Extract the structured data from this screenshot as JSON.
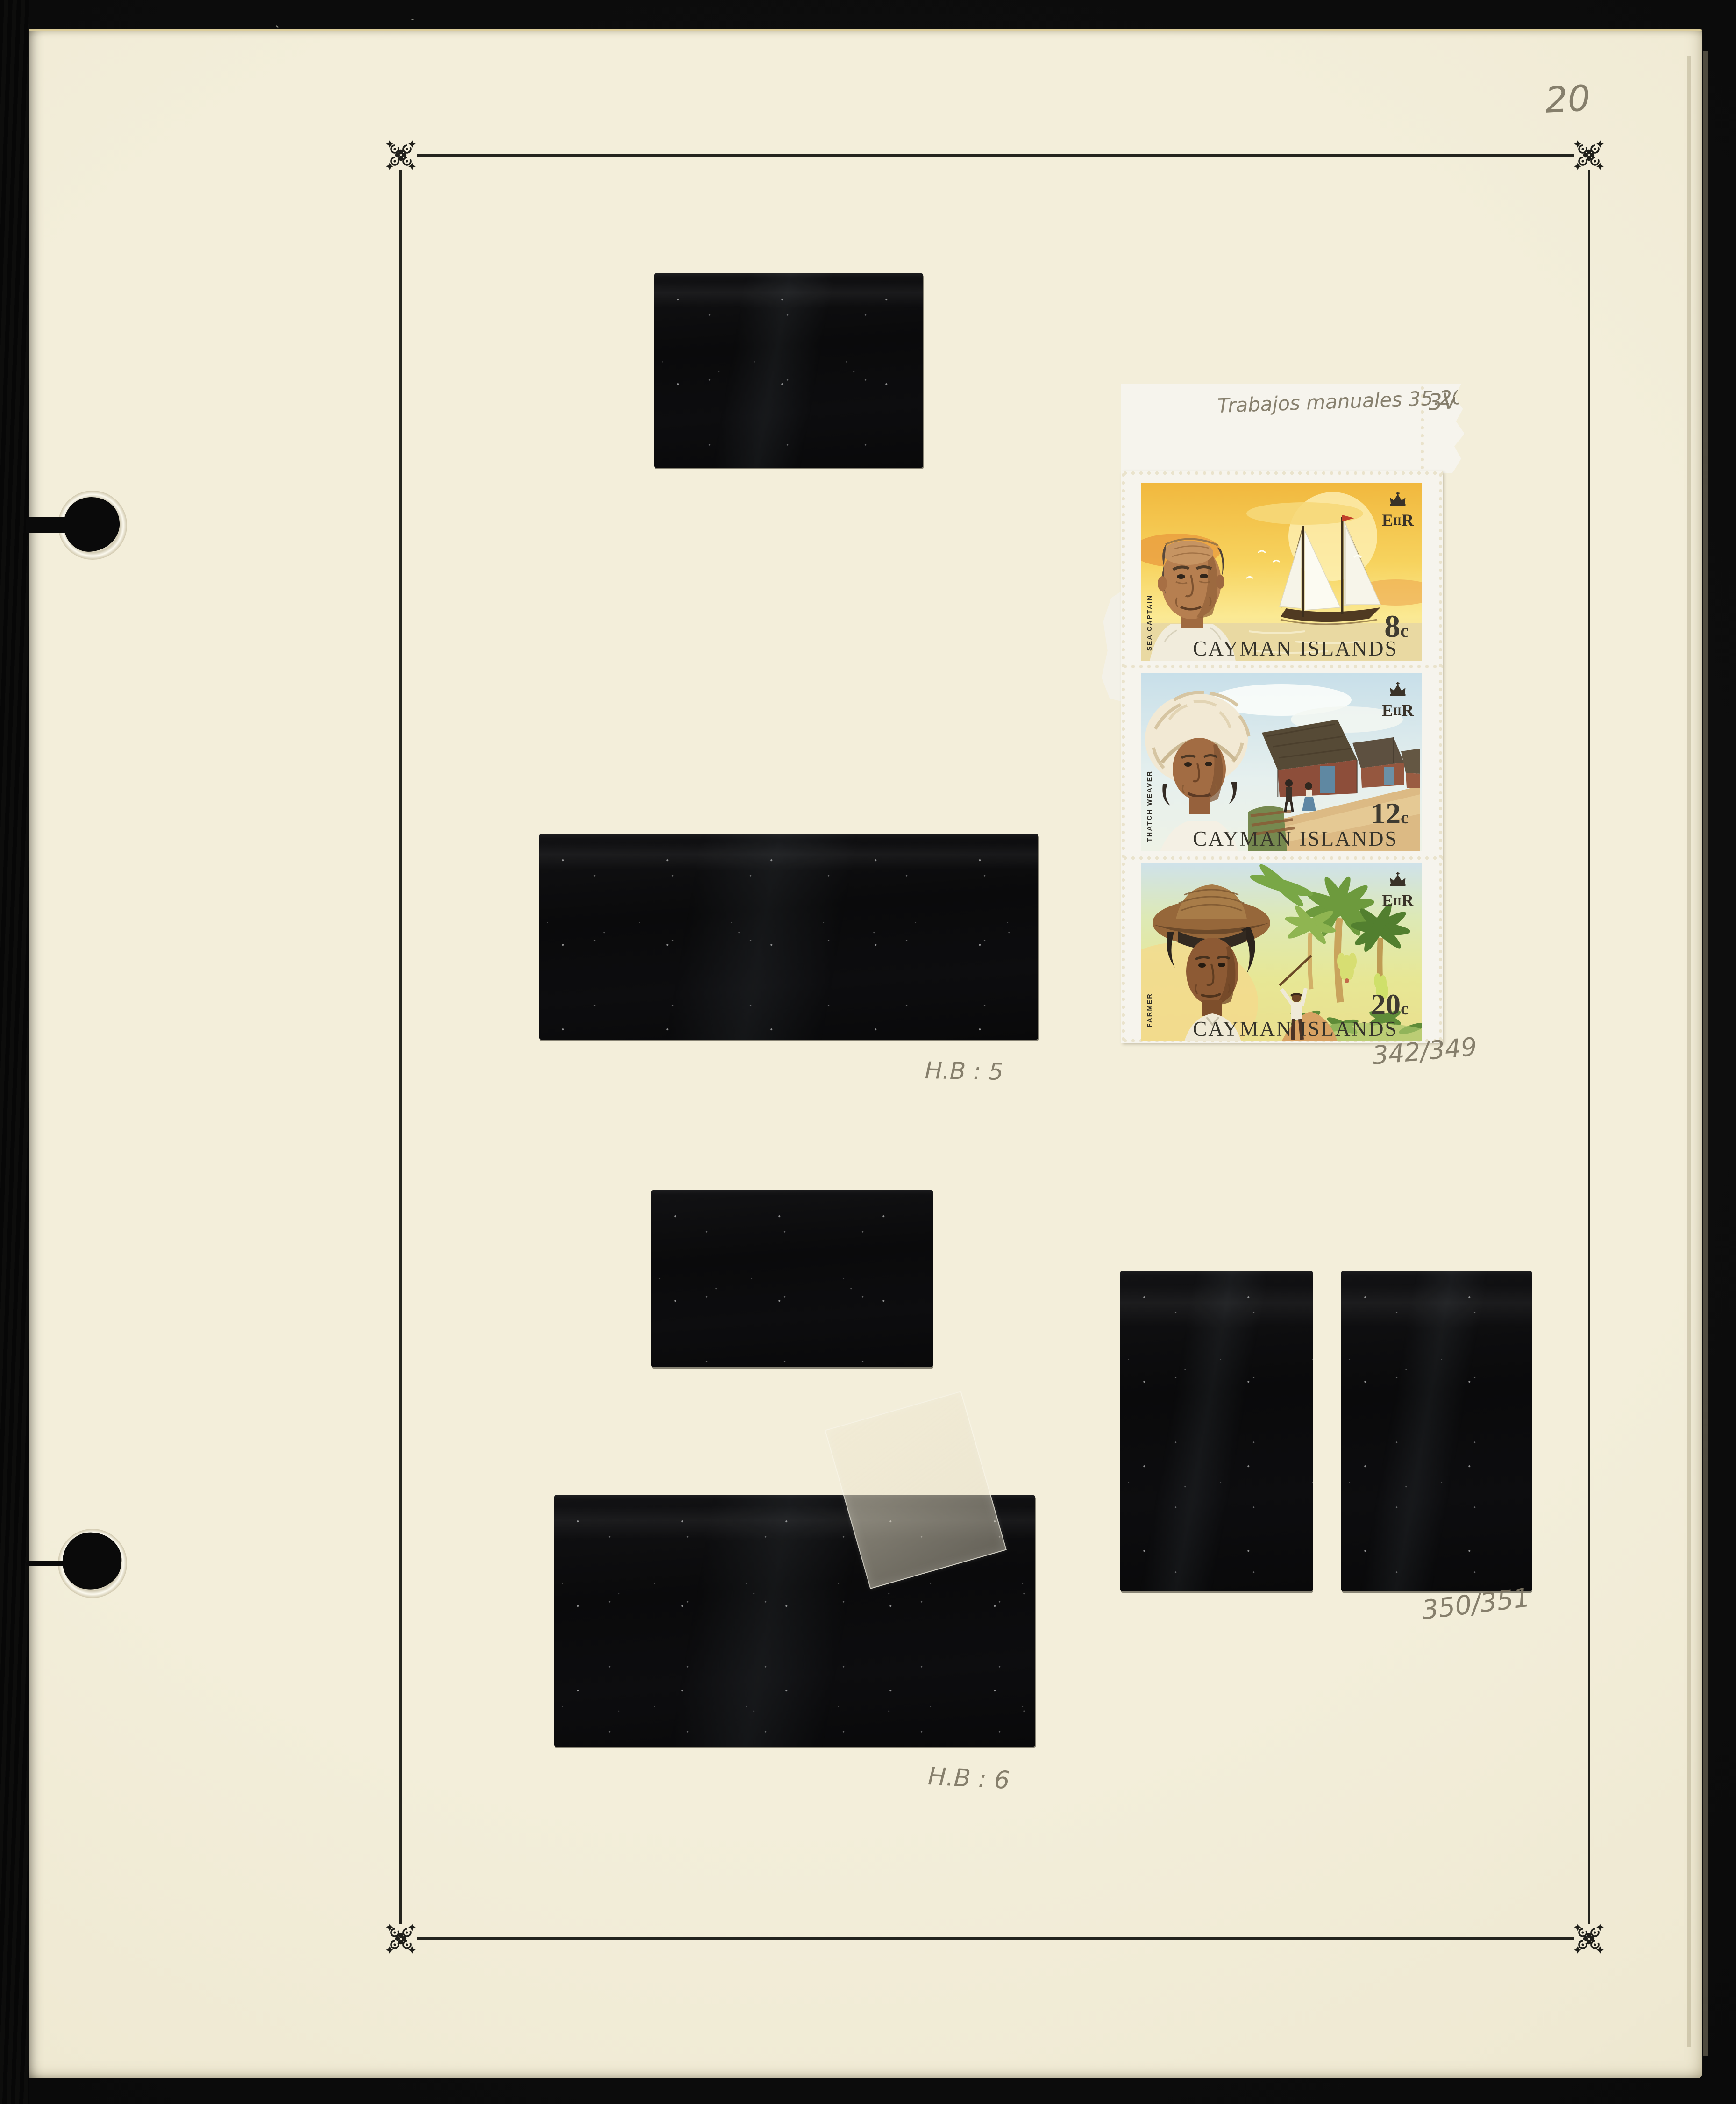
{
  "page_number": "20",
  "annotations": {
    "top_note": "Trabajos manuales  35.20",
    "variant_count": "3V",
    "hb_top": "H.B : 5",
    "catalog_top": "342/349",
    "catalog_bottom": "350/351",
    "hb_bottom": "H.B : 6"
  },
  "stamps": {
    "country": "CAYMAN ISLANDS",
    "unit": "c",
    "royal_cypher_parts": [
      "E",
      "II",
      "R"
    ],
    "items": [
      {
        "denomination": "8",
        "title": "SEA CAPTAIN"
      },
      {
        "denomination": "12",
        "title": "THATCH WEAVER"
      },
      {
        "denomination": "20",
        "title": "FARMER"
      }
    ]
  },
  "icons": {
    "corner_ornament": "printer-flower-ornament",
    "crown": "royal-crown",
    "binder_hole": "binder-post-hole"
  },
  "colors": {
    "page_cream": "#f1ecd6",
    "mount_black": "#0b0b0c",
    "pencil_gray": "#7d7563",
    "stamp1_sky": "#f6c94a",
    "stamp2_sky": "#cde2ec",
    "stamp3_foliage": "#7ba043",
    "frame_ink": "#24241e"
  }
}
